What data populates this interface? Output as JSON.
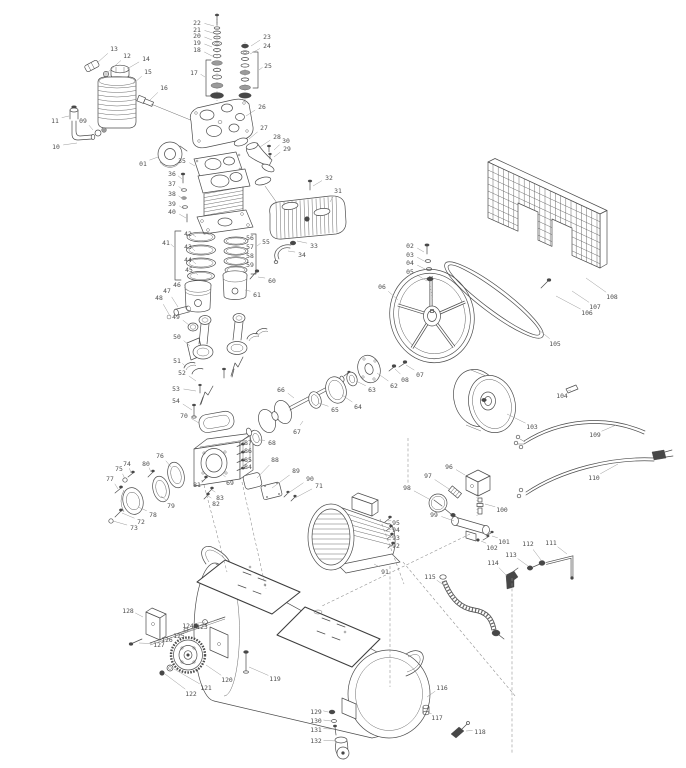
{
  "diagram": {
    "type": "exploded-parts-diagram",
    "subject": "belt-driven air compressor",
    "colors": {
      "line": "#4d4d4d",
      "label": "#4d4d4d",
      "leader": "#9a9a9a",
      "background": "#ffffff"
    },
    "label_columns": [
      "number",
      "x",
      "y",
      "leader_x",
      "leader_y"
    ],
    "labels": [
      [
        "01",
        143,
        166,
        158,
        157
      ],
      [
        "02",
        410,
        248,
        424,
        252
      ],
      [
        "03",
        410,
        257,
        426,
        262
      ],
      [
        "04",
        410,
        265,
        427,
        270
      ],
      [
        "05",
        410,
        274,
        427,
        281
      ],
      [
        "06",
        382,
        289,
        398,
        300
      ],
      [
        "07",
        420,
        377,
        406,
        365
      ],
      [
        "08",
        405,
        382,
        395,
        369
      ],
      [
        "09",
        83,
        123,
        93,
        130
      ],
      [
        "10",
        56,
        149,
        77,
        143
      ],
      [
        "11",
        55,
        123,
        69,
        116
      ],
      [
        "12",
        127,
        58,
        108,
        72
      ],
      [
        "13",
        114,
        51,
        97,
        63
      ],
      [
        "14",
        146,
        61,
        127,
        69
      ],
      [
        "15",
        148,
        74,
        133,
        84
      ],
      [
        "16",
        164,
        90,
        150,
        100
      ],
      [
        "17",
        194,
        75,
        205,
        77
      ],
      [
        "18",
        197,
        52,
        212,
        56
      ],
      [
        "19",
        197,
        45,
        212,
        47
      ],
      [
        "20",
        197,
        38,
        212,
        40
      ],
      [
        "21",
        197,
        32,
        213,
        33
      ],
      [
        "22",
        197,
        25,
        214,
        26
      ],
      [
        "23",
        267,
        39,
        251,
        46
      ],
      [
        "24",
        267,
        48,
        250,
        54
      ],
      [
        "25",
        268,
        68,
        259,
        70
      ],
      [
        "26",
        262,
        109,
        246,
        116
      ],
      [
        "27",
        264,
        130,
        249,
        139
      ],
      [
        "28",
        277,
        139,
        260,
        147
      ],
      [
        "29",
        287,
        151,
        274,
        157
      ],
      [
        "30",
        286,
        143,
        274,
        150
      ],
      [
        "31",
        338,
        193,
        330,
        202
      ],
      [
        "32",
        329,
        180,
        313,
        186
      ],
      [
        "33",
        314,
        248,
        297,
        241
      ],
      [
        "34",
        302,
        257,
        288,
        251
      ],
      [
        "35",
        182,
        163,
        195,
        166
      ],
      [
        "36",
        172,
        176,
        182,
        179
      ],
      [
        "37",
        172,
        186,
        183,
        190
      ],
      [
        "38",
        172,
        196,
        183,
        199
      ],
      [
        "39",
        172,
        206,
        184,
        209
      ],
      [
        "40",
        172,
        214,
        186,
        218
      ],
      [
        "41",
        166,
        245,
        174,
        247
      ],
      [
        "42",
        188,
        236,
        196,
        237
      ],
      [
        "43",
        188,
        249,
        195,
        251
      ],
      [
        "44",
        188,
        262,
        196,
        264
      ],
      [
        "45",
        189,
        272,
        198,
        275
      ],
      [
        "46",
        177,
        287,
        189,
        291
      ],
      [
        "47",
        167,
        293,
        178,
        307
      ],
      [
        "48",
        159,
        300,
        170,
        316
      ],
      [
        "49",
        176,
        319,
        189,
        325
      ],
      [
        "50",
        177,
        339,
        190,
        346
      ],
      [
        "51",
        177,
        363,
        186,
        367
      ],
      [
        "52",
        182,
        375,
        196,
        381
      ],
      [
        "53",
        176,
        391,
        196,
        391
      ],
      [
        "54",
        176,
        403,
        192,
        410
      ],
      [
        "55",
        266,
        244,
        257,
        246
      ],
      [
        "56",
        250,
        240,
        245,
        241
      ],
      [
        "57",
        250,
        249,
        245,
        251
      ],
      [
        "58",
        250,
        258,
        245,
        260
      ],
      [
        "59",
        250,
        267,
        244,
        269
      ],
      [
        "60",
        272,
        283,
        258,
        277
      ],
      [
        "61",
        257,
        297,
        245,
        290
      ],
      [
        "62",
        394,
        388,
        377,
        373
      ],
      [
        "63",
        372,
        392,
        356,
        381
      ],
      [
        "64",
        358,
        409,
        342,
        395
      ],
      [
        "65",
        335,
        412,
        319,
        403
      ],
      [
        "66",
        281,
        392,
        294,
        398
      ],
      [
        "67",
        297,
        434,
        303,
        421
      ],
      [
        "68",
        272,
        445,
        259,
        440
      ],
      [
        "69",
        230,
        485,
        222,
        474
      ],
      [
        "70",
        184,
        418,
        199,
        423
      ],
      [
        "71",
        319,
        488,
        295,
        498
      ],
      [
        "72",
        141,
        524,
        122,
        513
      ],
      [
        "73",
        134,
        530,
        113,
        521
      ],
      [
        "74",
        127,
        466,
        131,
        473
      ],
      [
        "75",
        119,
        471,
        125,
        479
      ],
      [
        "76",
        160,
        458,
        171,
        467
      ],
      [
        "77",
        110,
        481,
        118,
        489
      ],
      [
        "78",
        153,
        517,
        138,
        507
      ],
      [
        "79",
        171,
        508,
        161,
        496
      ],
      [
        "80",
        146,
        466,
        151,
        472
      ],
      [
        "81",
        197,
        487,
        204,
        480
      ],
      [
        "82",
        216,
        506,
        208,
        496
      ],
      [
        "83",
        220,
        500,
        212,
        490
      ],
      [
        "84",
        248,
        469,
        243,
        468
      ],
      [
        "85",
        248,
        462,
        243,
        460
      ],
      [
        "86",
        248,
        453,
        243,
        452
      ],
      [
        "87",
        248,
        445,
        243,
        444
      ],
      [
        "88",
        275,
        462,
        257,
        478
      ],
      [
        "89",
        296,
        473,
        272,
        488
      ],
      [
        "90",
        310,
        481,
        287,
        494
      ],
      [
        "91",
        385,
        574,
        374,
        564
      ],
      [
        "92",
        396,
        548,
        391,
        547
      ],
      [
        "93",
        396,
        540,
        390,
        538
      ],
      [
        "94",
        396,
        532,
        389,
        530
      ],
      [
        "95",
        396,
        525,
        388,
        521
      ],
      [
        "96",
        449,
        469,
        465,
        475
      ],
      [
        "97",
        428,
        478,
        449,
        489
      ],
      [
        "98",
        407,
        490,
        429,
        499
      ],
      [
        "99",
        434,
        517,
        454,
        521
      ],
      [
        "100",
        502,
        512,
        485,
        504
      ],
      [
        "101",
        504,
        544,
        492,
        536
      ],
      [
        "102",
        492,
        550,
        481,
        541
      ],
      [
        "103",
        532,
        429,
        507,
        414
      ],
      [
        "104",
        562,
        398,
        571,
        390
      ],
      [
        "105",
        555,
        346,
        539,
        330
      ],
      [
        "106",
        587,
        315,
        556,
        296
      ],
      [
        "107",
        595,
        309,
        572,
        291
      ],
      [
        "108",
        612,
        299,
        586,
        278
      ],
      [
        "109",
        595,
        437,
        616,
        425
      ],
      [
        "110",
        594,
        480,
        618,
        464
      ],
      [
        "111",
        551,
        545,
        567,
        554
      ],
      [
        "112",
        528,
        546,
        541,
        560
      ],
      [
        "113",
        511,
        557,
        528,
        566
      ],
      [
        "114",
        493,
        565,
        507,
        576
      ],
      [
        "115",
        430,
        579,
        445,
        586
      ],
      [
        "116",
        442,
        690,
        427,
        697
      ],
      [
        "117",
        437,
        720,
        428,
        713
      ],
      [
        "118",
        480,
        734,
        466,
        731
      ],
      [
        "119",
        275,
        681,
        249,
        667
      ],
      [
        "120",
        227,
        682,
        206,
        665
      ],
      [
        "121",
        206,
        690,
        174,
        669
      ],
      [
        "122",
        191,
        696,
        165,
        674
      ],
      [
        "123",
        202,
        629,
        218,
        619
      ],
      [
        "124",
        188,
        628,
        205,
        622
      ],
      [
        "125",
        179,
        638,
        196,
        628
      ],
      [
        "126",
        167,
        642,
        185,
        632
      ],
      [
        "127",
        159,
        647,
        139,
        643
      ],
      [
        "128",
        128,
        613,
        143,
        617
      ],
      [
        "129",
        316,
        714,
        328,
        712
      ],
      [
        "130",
        316,
        723,
        331,
        721
      ],
      [
        "131",
        316,
        732,
        333,
        729
      ],
      [
        "132",
        316,
        743,
        336,
        741
      ]
    ]
  }
}
